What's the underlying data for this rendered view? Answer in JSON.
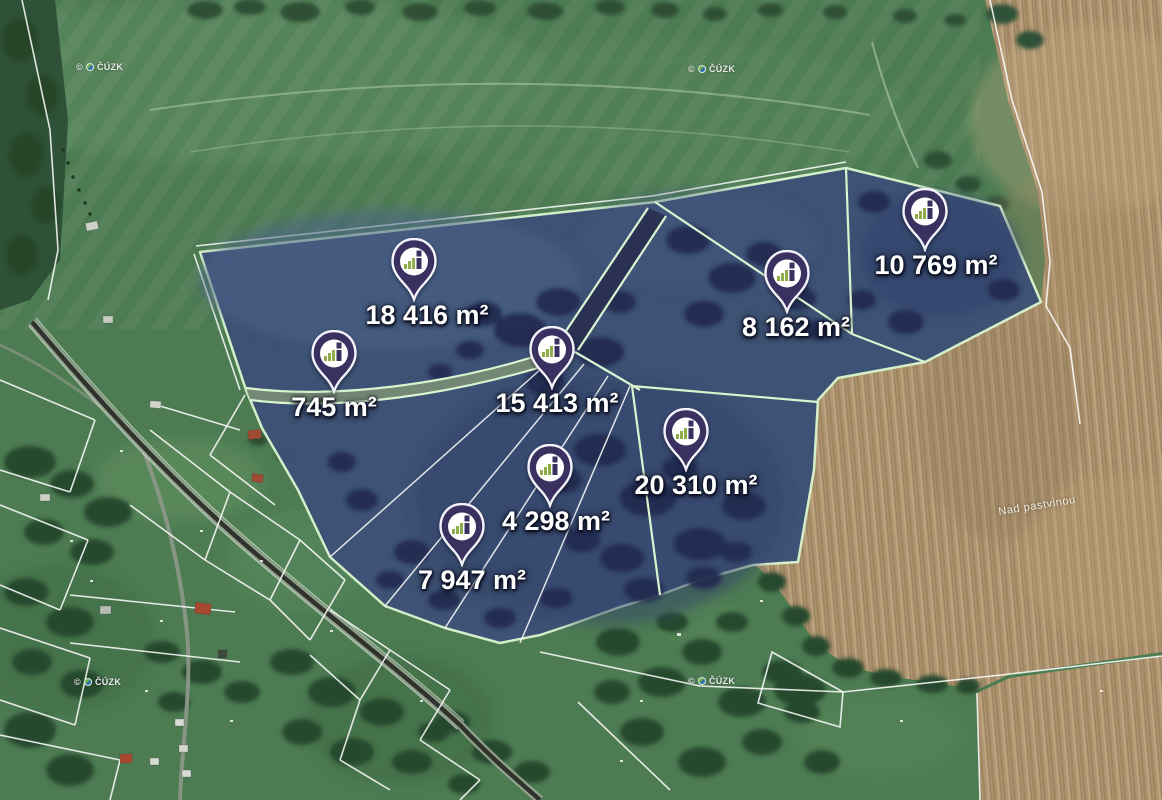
{
  "map": {
    "attribution": {
      "copyright": "©",
      "agency": "ČÚZK"
    },
    "place_label": "Nad pastvinou",
    "pins": [
      {
        "label": "18 416 m²"
      },
      {
        "label": "745 m²"
      },
      {
        "label": "15 413 m²"
      },
      {
        "label": "4 298 m²"
      },
      {
        "label": "7 947 m²"
      },
      {
        "label": "20 310 m²"
      },
      {
        "label": "8 162 m²"
      },
      {
        "label": "10 769 m²"
      }
    ],
    "colors": {
      "pin_fill": "#3A3160",
      "pin_ring": "#FFFFFF",
      "pin_chart_green": "#8FAE4B",
      "parcel_overlay": "#3D5176",
      "parcel_border": "#D9F4D0",
      "cadastral_line": "#FFFFFF",
      "meadow_green": "#4D7C53",
      "field_brown": "#B09573",
      "label_text": "#FFFFFF"
    }
  }
}
